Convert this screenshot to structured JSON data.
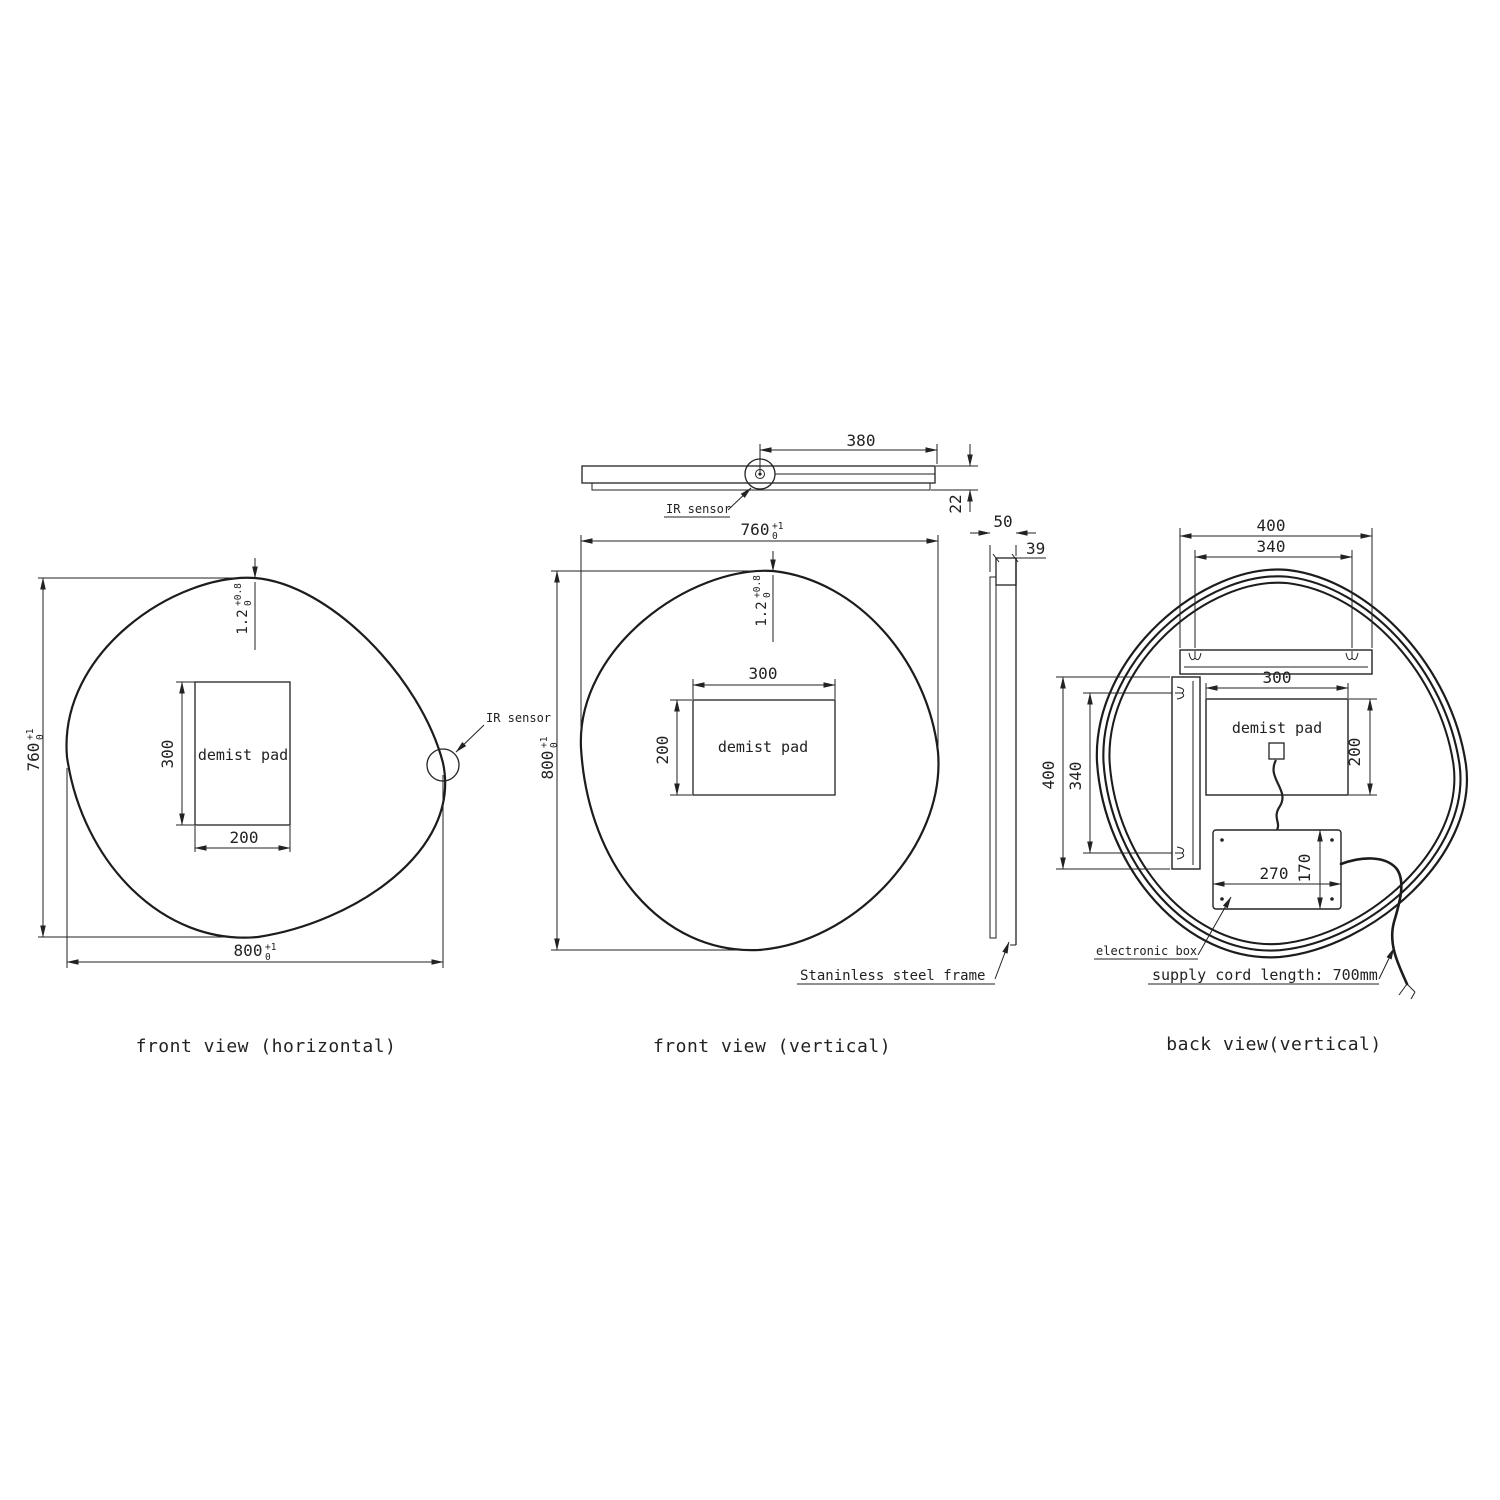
{
  "drawing": {
    "captions": {
      "front_horizontal": "front view (horizontal)",
      "front_vertical": "front view (vertical)",
      "back_vertical": "back view(vertical)"
    },
    "top_view": {
      "sensor_offset": "380",
      "thickness": "22",
      "ir_sensor_label": "IR sensor"
    },
    "front_horizontal": {
      "height": {
        "value": "760",
        "tol_plus": "+1",
        "tol_minus": "0"
      },
      "width": {
        "value": "800",
        "tol_plus": "+1",
        "tol_minus": "0"
      },
      "edge_thickness": {
        "value": "1.2",
        "tol_plus": "+0.8",
        "tol_minus": "0"
      },
      "pad_label": "demist pad",
      "pad_height": "300",
      "pad_width": "200",
      "ir_sensor_label": "IR sensor"
    },
    "front_vertical": {
      "width": {
        "value": "760",
        "tol_plus": "+1",
        "tol_minus": "0"
      },
      "height": {
        "value": "800",
        "tol_plus": "+1",
        "tol_minus": "0"
      },
      "edge_thickness": {
        "value": "1.2",
        "tol_plus": "+0.8",
        "tol_minus": "0"
      },
      "pad_label": "demist pad",
      "pad_width": "300",
      "pad_height": "200",
      "depth_total": "50",
      "depth_frame": "39",
      "frame_label": "Staninless steel frame"
    },
    "back_view": {
      "top_bracket_outer": "400",
      "top_bracket_inner": "340",
      "side_bracket_outer": "400",
      "side_bracket_inner": "340",
      "pad_label": "demist pad",
      "pad_width": "300",
      "pad_height": "200",
      "box_width": "270",
      "box_height": "170",
      "electronic_box_label": "electronic box",
      "supply_cord_label": "supply cord length: 700mm"
    }
  }
}
